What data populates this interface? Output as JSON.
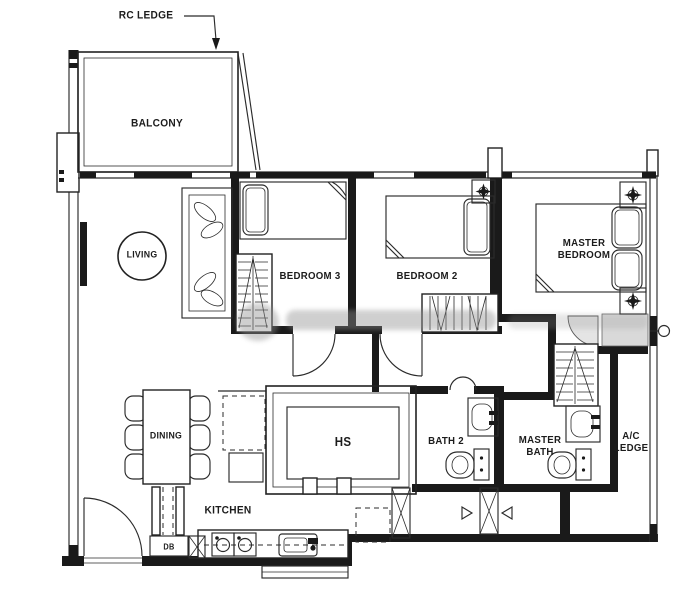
{
  "labels": {
    "rc_ledge": "RC LEDGE",
    "balcony": "BALCONY",
    "living": "LIVING",
    "bedroom3": "BEDROOM 3",
    "bedroom2": "BEDROOM 2",
    "master_bedroom": "MASTER\nBEDROOM",
    "dining": "DINING",
    "hs": "HS",
    "bath2": "BATH 2",
    "master_bath": "MASTER\nBATH",
    "ac_ledge": "A/C\nLEDGE",
    "kitchen": "KITCHEN",
    "db": "DB"
  },
  "colors": {
    "background": "#ffffff",
    "line": "#2b2b2b",
    "wall": "#1a1a1a",
    "shower_fill": "#d9d9d9",
    "watermark": "#8f8f8f"
  },
  "icons": [
    "bed-icon",
    "pillow-icon",
    "sofa-icon",
    "dining-table-icon",
    "chair-icon",
    "wardrobe-icon",
    "toilet-icon",
    "sink-icon",
    "cooktop-icon",
    "kitchen-sink-icon",
    "fridge-icon",
    "door-arc-icon",
    "ceiling-fan-icon",
    "gas-riser-icon",
    "leader-arrow-icon"
  ]
}
